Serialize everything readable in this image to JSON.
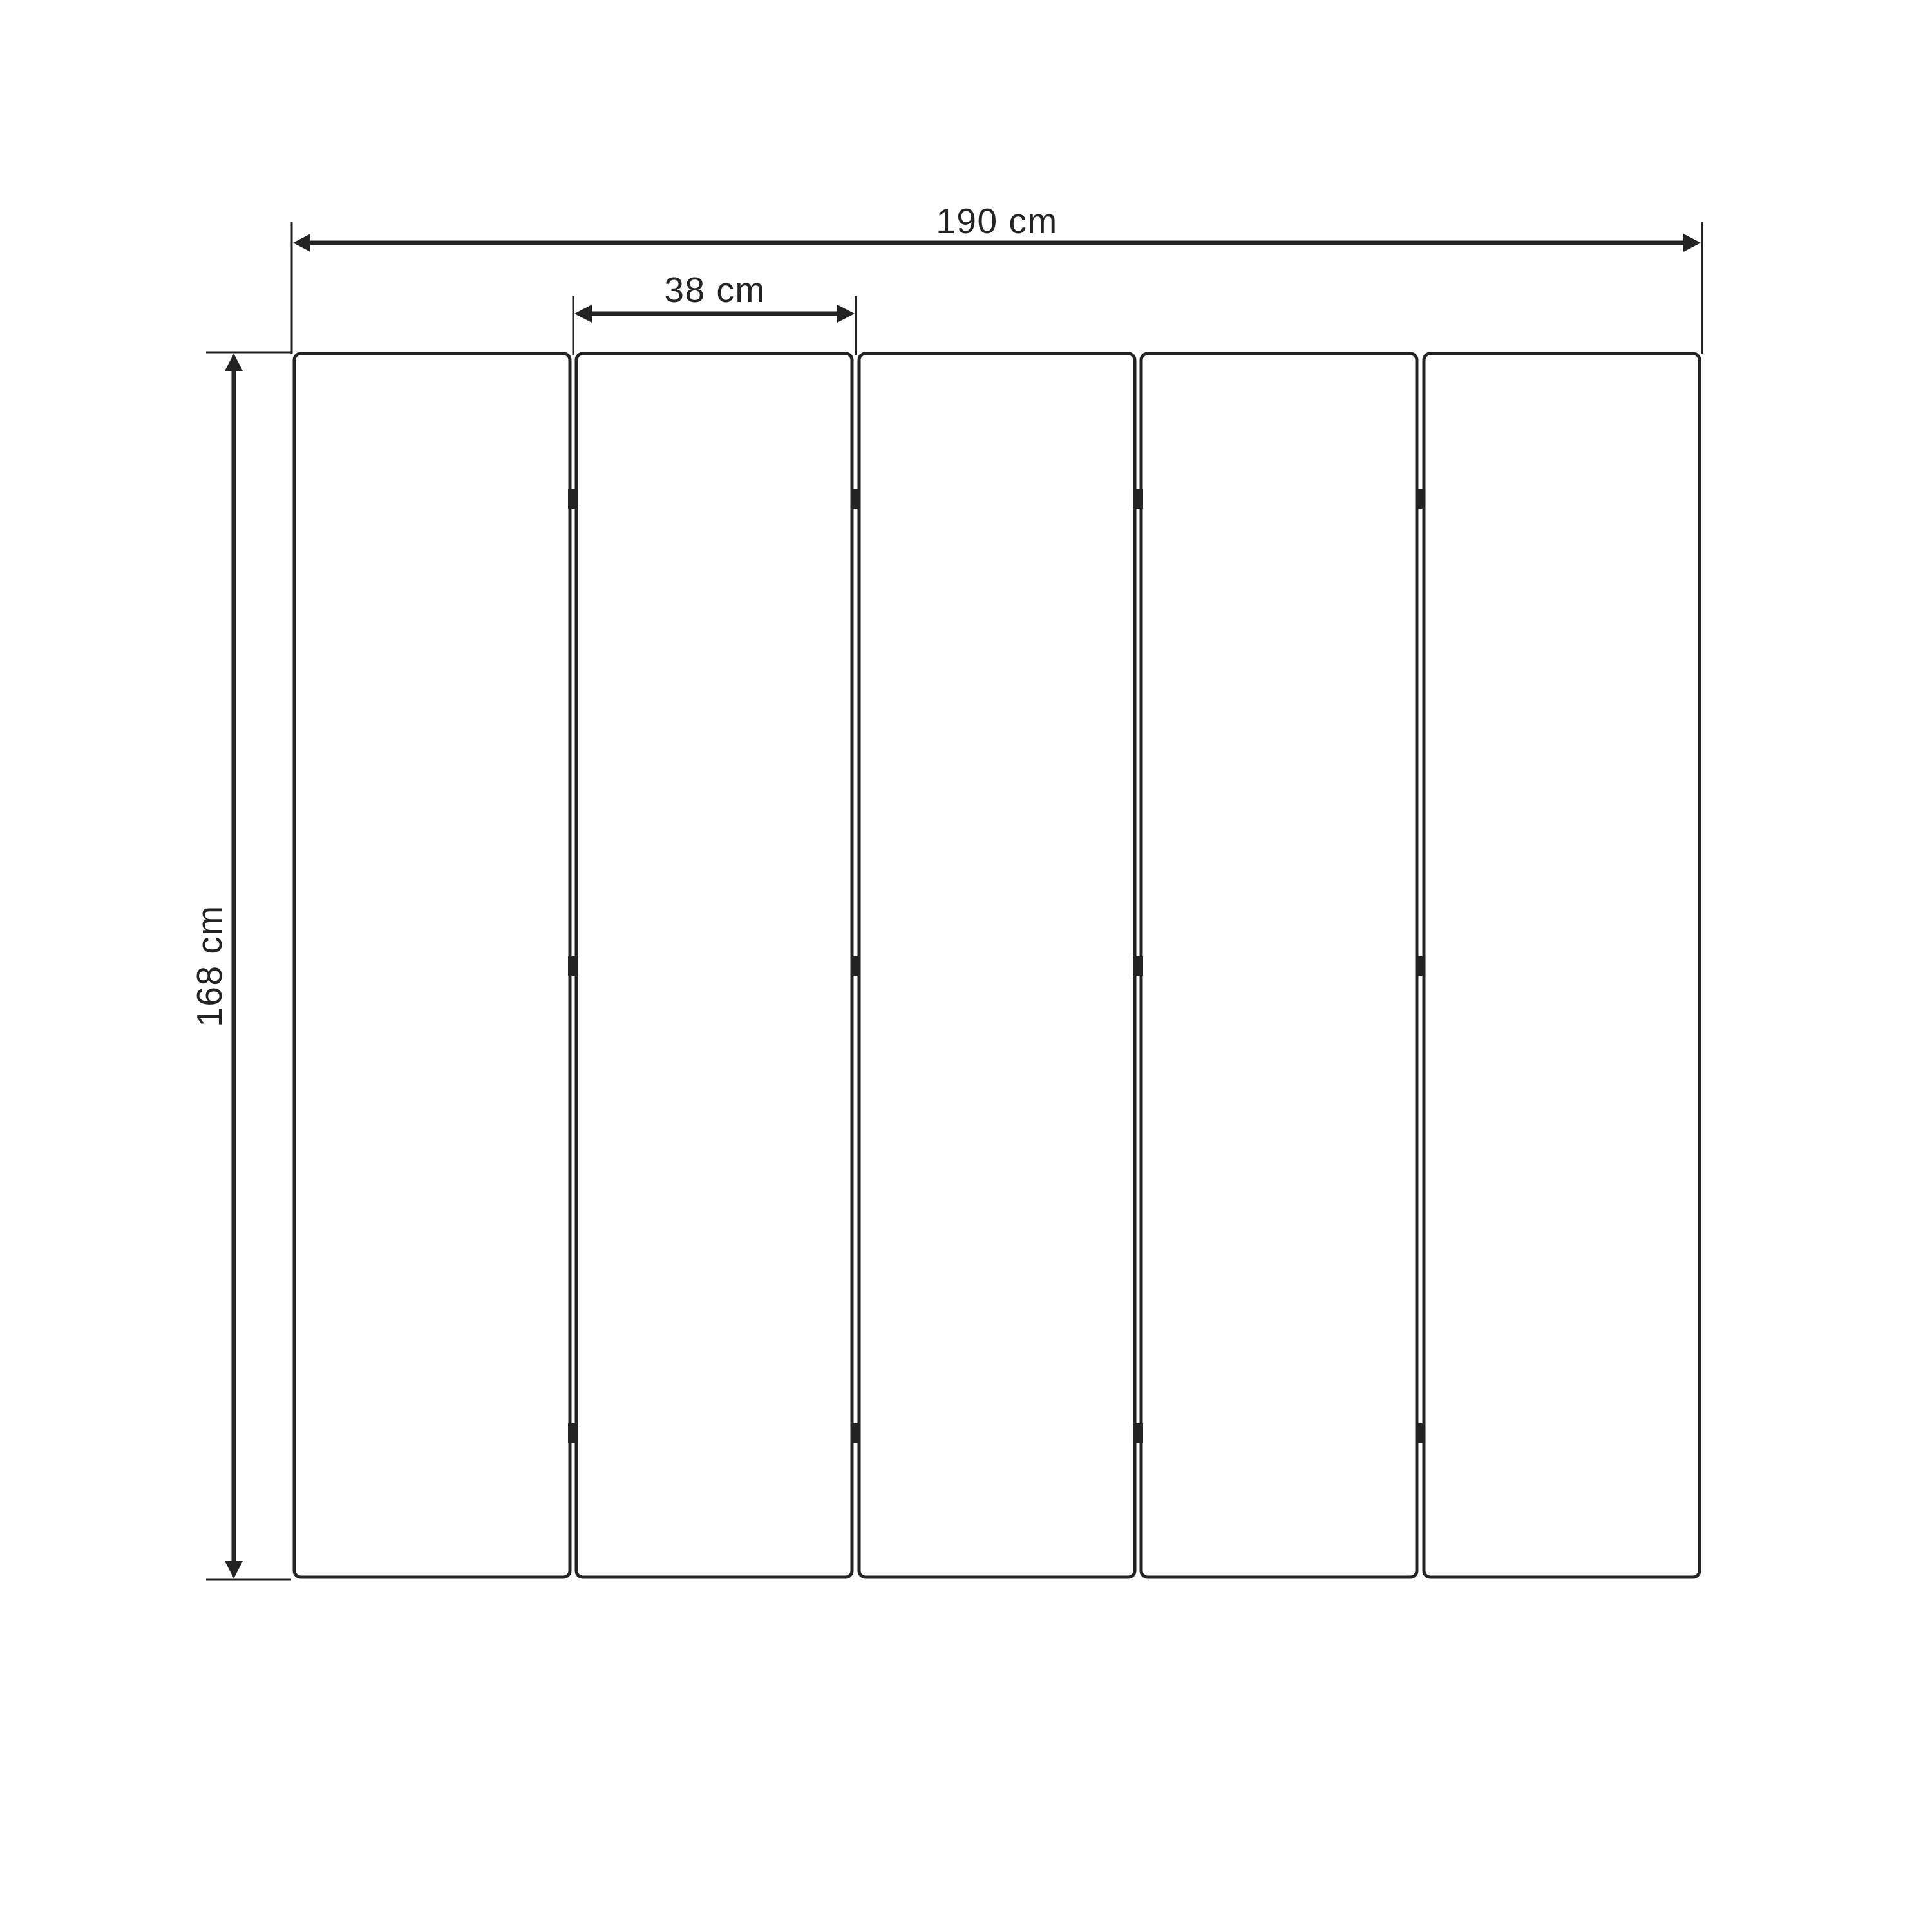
{
  "diagram": {
    "type": "technical-drawing",
    "subject": "five-panel folding screen, front elevation",
    "panel_count": 5,
    "hinge_rows_per_gap": 3,
    "dimensions": {
      "total_width": "190 cm",
      "panel_width": "38 cm",
      "height": "168 cm"
    }
  },
  "colors": {
    "line": "#232323",
    "background": "#ffffff"
  }
}
